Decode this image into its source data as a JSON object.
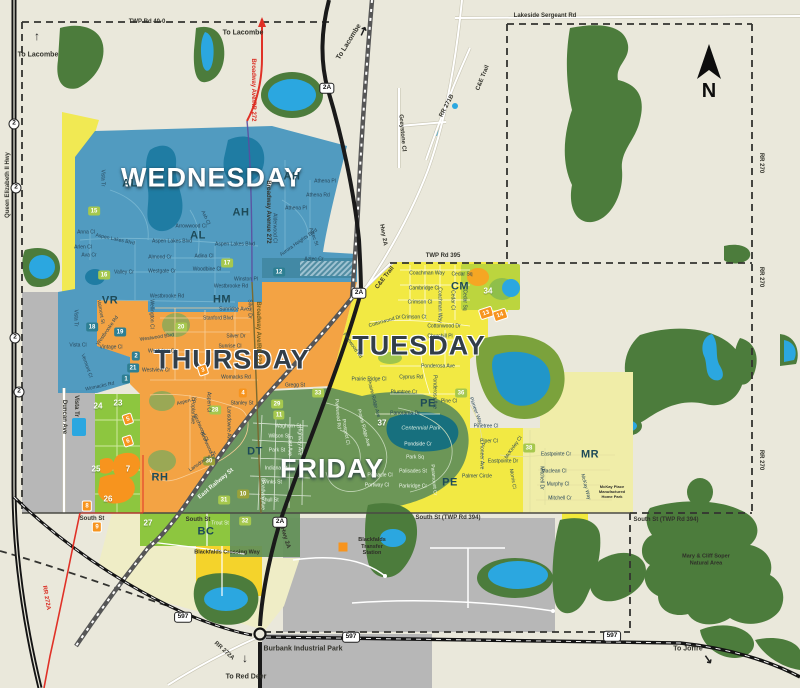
{
  "colors": {
    "background": "#EAE8DB",
    "forest": "#4C7C3C",
    "water": "#2BA7E0",
    "wednesday": "#4796BE",
    "thursday": "#F2A03D",
    "tuesday": "#F2E93B",
    "friday": "#639158",
    "pale_yellow_mr": "#F0EDA8",
    "pale_yellow_bc": "#EFEDC6",
    "green_strip": "#8DC63F",
    "gray_area": "#B7B7B7",
    "road_black": "#1A1A1A",
    "road_red": "#E03127",
    "box_green": "#A6C84E",
    "box_teal": "#2E7F93",
    "box_orange": "#F7941E"
  },
  "compass": {
    "label": "N"
  },
  "day_labels": [
    {
      "t": "WEDNESDAY",
      "x": 212,
      "y": 178,
      "k": "light"
    },
    {
      "t": "THURSDAY",
      "x": 232,
      "y": 360,
      "k": "dark"
    },
    {
      "t": "TUESDAY",
      "x": 419,
      "y": 346,
      "k": "dark"
    },
    {
      "t": "FRIDAY",
      "x": 332,
      "y": 469,
      "k": "light"
    }
  ],
  "district_labels": [
    {
      "t": "AL",
      "x": 130,
      "y": 184
    },
    {
      "t": "AH",
      "x": 292,
      "y": 177
    },
    {
      "t": "AH",
      "x": 241,
      "y": 213
    },
    {
      "t": "AL",
      "x": 198,
      "y": 236
    },
    {
      "t": "VR",
      "x": 110,
      "y": 301
    },
    {
      "t": "HM",
      "x": 222,
      "y": 300
    },
    {
      "t": "CM",
      "x": 460,
      "y": 287
    },
    {
      "t": "PE",
      "x": 428,
      "y": 404
    },
    {
      "t": "PE",
      "x": 450,
      "y": 483
    },
    {
      "t": "DT",
      "x": 255,
      "y": 452
    },
    {
      "t": "RH",
      "x": 160,
      "y": 478
    },
    {
      "t": "BC",
      "x": 206,
      "y": 532
    },
    {
      "t": "MR",
      "x": 590,
      "y": 455
    }
  ],
  "markers_green": [
    {
      "t": "15",
      "x": 94,
      "y": 211
    },
    {
      "t": "16",
      "x": 104,
      "y": 275
    },
    {
      "t": "17",
      "x": 227,
      "y": 263
    },
    {
      "t": "20",
      "x": 181,
      "y": 327
    },
    {
      "t": "28",
      "x": 215,
      "y": 410
    },
    {
      "t": "29",
      "x": 277,
      "y": 404
    },
    {
      "t": "11",
      "x": 279,
      "y": 415
    },
    {
      "t": "31",
      "x": 224,
      "y": 500
    },
    {
      "t": "32",
      "x": 245,
      "y": 521
    },
    {
      "t": "33",
      "x": 318,
      "y": 393
    },
    {
      "t": "36",
      "x": 461,
      "y": 393
    },
    {
      "t": "38",
      "x": 529,
      "y": 448
    }
  ],
  "markers_teal": [
    {
      "t": "12",
      "x": 279,
      "y": 272
    },
    {
      "t": "18",
      "x": 92,
      "y": 327
    },
    {
      "t": "19",
      "x": 120,
      "y": 332
    },
    {
      "t": "2",
      "x": 136,
      "y": 356
    },
    {
      "t": "21",
      "x": 133,
      "y": 368
    },
    {
      "t": "1",
      "x": 126,
      "y": 379
    }
  ],
  "markers_orange": [
    {
      "t": "4",
      "x": 243,
      "y": 393
    },
    {
      "t": "8",
      "x": 87,
      "y": 506,
      "k": "bordered"
    },
    {
      "t": "9",
      "x": 97,
      "y": 527,
      "k": "bordered"
    }
  ],
  "markers_tilted": [
    {
      "t": "3",
      "x": 203,
      "y": 370
    },
    {
      "t": "5",
      "x": 128,
      "y": 419
    },
    {
      "t": "6",
      "x": 128,
      "y": 441
    },
    {
      "t": "13",
      "x": 486,
      "y": 313
    },
    {
      "t": "14",
      "x": 500,
      "y": 315
    }
  ],
  "markers_olive": [
    {
      "t": "10",
      "x": 243,
      "y": 494
    },
    {
      "t": "30",
      "x": 209,
      "y": 461
    }
  ],
  "markers_plain": [
    {
      "t": "23",
      "x": 118,
      "y": 403
    },
    {
      "t": "24",
      "x": 98,
      "y": 406
    },
    {
      "t": "25",
      "x": 96,
      "y": 469
    },
    {
      "t": "26",
      "x": 108,
      "y": 499
    },
    {
      "t": "27",
      "x": 148,
      "y": 523
    },
    {
      "t": "34",
      "x": 488,
      "y": 291
    },
    {
      "t": "37",
      "x": 382,
      "y": 423
    },
    {
      "t": "7",
      "x": 128,
      "y": 469
    }
  ],
  "street_labels": [
    {
      "t": "Vista Tr",
      "x": 102,
      "y": 178,
      "r": 90
    },
    {
      "t": "Athena Pl",
      "x": 325,
      "y": 182
    },
    {
      "t": "Athena Rd",
      "x": 318,
      "y": 196
    },
    {
      "t": "Athena Pl",
      "x": 296,
      "y": 209
    },
    {
      "t": "Alderwood Cl",
      "x": 274,
      "y": 228,
      "r": 90
    },
    {
      "t": "Aurora Heights Blvd",
      "x": 299,
      "y": 243,
      "r": -35
    },
    {
      "t": "Aztec St",
      "x": 313,
      "y": 237,
      "r": 70
    },
    {
      "t": "Aztec Cr",
      "x": 314,
      "y": 260
    },
    {
      "t": "Arrowwood Cl",
      "x": 191,
      "y": 227
    },
    {
      "t": "Ash Cl",
      "x": 205,
      "y": 218,
      "r": 65
    },
    {
      "t": "Aspen Lakes Blvd",
      "x": 115,
      "y": 240,
      "r": 12
    },
    {
      "t": "Aspen Lakes Blvd",
      "x": 172,
      "y": 242
    },
    {
      "t": "Aspen Lakes Blvd",
      "x": 235,
      "y": 245
    },
    {
      "t": "Anna Cl",
      "x": 86,
      "y": 233
    },
    {
      "t": "Arlen Cl",
      "x": 83,
      "y": 248
    },
    {
      "t": "Ava Cr",
      "x": 89,
      "y": 256
    },
    {
      "t": "Adina Cl",
      "x": 204,
      "y": 257
    },
    {
      "t": "Almond Cr",
      "x": 160,
      "y": 258
    },
    {
      "t": "Woodbine Cl",
      "x": 207,
      "y": 270
    },
    {
      "t": "Westgate Cr",
      "x": 162,
      "y": 272
    },
    {
      "t": "Valley Cr",
      "x": 124,
      "y": 273
    },
    {
      "t": "Winston Pl",
      "x": 246,
      "y": 280
    },
    {
      "t": "Westbrooke Rd",
      "x": 231,
      "y": 287
    },
    {
      "t": "Westbrooke Rd",
      "x": 167,
      "y": 297
    },
    {
      "t": "Valmont St",
      "x": 100,
      "y": 312,
      "r": 80
    },
    {
      "t": "Vista Tr",
      "x": 75,
      "y": 318,
      "r": 90
    },
    {
      "t": "Westbrooke Rd",
      "x": 108,
      "y": 331,
      "r": -55
    },
    {
      "t": "Vintage Cl",
      "x": 111,
      "y": 348
    },
    {
      "t": "Vista Cl",
      "x": 78,
      "y": 346
    },
    {
      "t": "Vermont Cl",
      "x": 86,
      "y": 366,
      "r": 70
    },
    {
      "t": "Womacks Rd",
      "x": 100,
      "y": 387,
      "r": -12
    },
    {
      "t": "Wellington Cl",
      "x": 151,
      "y": 314,
      "r": 90
    },
    {
      "t": "Sunridge Ave",
      "x": 234,
      "y": 310
    },
    {
      "t": "Stanford Blvd",
      "x": 218,
      "y": 319
    },
    {
      "t": "Silver Dr",
      "x": 249,
      "y": 309,
      "r": 90
    },
    {
      "t": "Silver Dr",
      "x": 236,
      "y": 337
    },
    {
      "t": "Sunrise Cl",
      "x": 230,
      "y": 347
    },
    {
      "t": "Westwood Blvd",
      "x": 157,
      "y": 338,
      "r": -8
    },
    {
      "t": "Westview Cr",
      "x": 162,
      "y": 352
    },
    {
      "t": "Westview Cr",
      "x": 156,
      "y": 371
    },
    {
      "t": "Womacks Rd",
      "x": 236,
      "y": 378
    },
    {
      "t": "Gregg St",
      "x": 295,
      "y": 386
    },
    {
      "t": "Aspen Dr",
      "x": 187,
      "y": 402,
      "r": -15
    },
    {
      "t": "Poplar Ave",
      "x": 192,
      "y": 412,
      "r": 90
    },
    {
      "t": "Aspen Cl",
      "x": 208,
      "y": 402,
      "r": 90
    },
    {
      "t": "Stanley St",
      "x": 242,
      "y": 404
    },
    {
      "t": "Birchwood Cl",
      "x": 200,
      "y": 428,
      "r": 65
    },
    {
      "t": "Birchwood Dr",
      "x": 207,
      "y": 446,
      "r": 65
    },
    {
      "t": "Lansdowne Ave",
      "x": 228,
      "y": 424,
      "r": 90
    },
    {
      "t": "Lansdowne Dr",
      "x": 203,
      "y": 462,
      "r": -35
    },
    {
      "t": "Waghorn St",
      "x": 288,
      "y": 427,
      "k": "w"
    },
    {
      "t": "Wilson St",
      "x": 279,
      "y": 437,
      "k": "w"
    },
    {
      "t": "East Ave",
      "x": 289,
      "y": 446,
      "r": 90,
      "k": "w"
    },
    {
      "t": "Highway Ave",
      "x": 299,
      "y": 441,
      "r": 90,
      "k": "w"
    },
    {
      "t": "Park St",
      "x": 277,
      "y": 451,
      "k": "w"
    },
    {
      "t": "Indiana St",
      "x": 276,
      "y": 469,
      "k": "w"
    },
    {
      "t": "Winks St",
      "x": 272,
      "y": 483,
      "k": "w"
    },
    {
      "t": "Shull St",
      "x": 270,
      "y": 501,
      "k": "w"
    },
    {
      "t": "Broadway Ave",
      "x": 262,
      "y": 494,
      "r": 90,
      "k": "w"
    },
    {
      "t": "Trout St",
      "x": 220,
      "y": 524,
      "k": "w"
    },
    {
      "t": "Coachman Way",
      "x": 427,
      "y": 274
    },
    {
      "t": "Cedar Sq",
      "x": 462,
      "y": 275
    },
    {
      "t": "Cambridge Cl",
      "x": 424,
      "y": 289
    },
    {
      "t": "Crimson Cl",
      "x": 420,
      "y": 303
    },
    {
      "t": "Crimson Ct",
      "x": 414,
      "y": 318
    },
    {
      "t": "Coachman Way",
      "x": 439,
      "y": 305,
      "r": 90
    },
    {
      "t": "Cedar Cl",
      "x": 452,
      "y": 300,
      "r": 90
    },
    {
      "t": "Cedar Sq",
      "x": 464,
      "y": 300,
      "r": 90
    },
    {
      "t": "Cottonwood Dr",
      "x": 385,
      "y": 322,
      "r": -16
    },
    {
      "t": "Cottonwood Dr",
      "x": 444,
      "y": 327
    },
    {
      "t": "Churchill Pl",
      "x": 440,
      "y": 337
    },
    {
      "t": "Ponderosa Ave",
      "x": 438,
      "y": 367
    },
    {
      "t": "Ponderosa Ave",
      "x": 434,
      "y": 392,
      "r": 90
    },
    {
      "t": "Cyprus Rd",
      "x": 411,
      "y": 378
    },
    {
      "t": "Plumtree Cr",
      "x": 404,
      "y": 393
    },
    {
      "t": "Pine Cl",
      "x": 449,
      "y": 402
    },
    {
      "t": "Pinewood Rd",
      "x": 352,
      "y": 346,
      "r": 55
    },
    {
      "t": "Prairie Ridge Cl",
      "x": 369,
      "y": 380
    },
    {
      "t": "Prairie Ridge Ave",
      "x": 373,
      "y": 399,
      "r": 75
    },
    {
      "t": "Panorama Dr",
      "x": 405,
      "y": 414
    },
    {
      "t": "Parkwood Rd",
      "x": 337,
      "y": 414,
      "r": 85,
      "k": "w"
    },
    {
      "t": "Prospect Cl",
      "x": 345,
      "y": 432,
      "r": 80,
      "k": "w"
    },
    {
      "t": "Prairie Ridge Ave",
      "x": 363,
      "y": 428,
      "r": 75,
      "k": "w"
    },
    {
      "t": "Pondside Cr",
      "x": 418,
      "y": 445,
      "k": "w"
    },
    {
      "t": "Park Sq",
      "x": 415,
      "y": 458,
      "k": "w"
    },
    {
      "t": "Palisades St",
      "x": 413,
      "y": 472,
      "k": "w"
    },
    {
      "t": "Pinnacle Cl",
      "x": 380,
      "y": 476,
      "k": "w"
    },
    {
      "t": "Portway Cl",
      "x": 377,
      "y": 486,
      "k": "w"
    },
    {
      "t": "Parkridge Cr",
      "x": 413,
      "y": 487,
      "k": "w"
    },
    {
      "t": "Paramount Cr",
      "x": 433,
      "y": 480,
      "r": 85,
      "k": "w"
    },
    {
      "t": "Pioneer Way",
      "x": 475,
      "y": 411,
      "r": 70
    },
    {
      "t": "Pinetree Cl",
      "x": 486,
      "y": 427
    },
    {
      "t": "Piper Cl",
      "x": 489,
      "y": 442
    },
    {
      "t": "Pioneer Ave",
      "x": 481,
      "y": 456,
      "r": 90
    },
    {
      "t": "Palmer Circle",
      "x": 477,
      "y": 477
    },
    {
      "t": "Eastpointe Dr",
      "x": 503,
      "y": 462
    },
    {
      "t": "Eastpointe Cr",
      "x": 556,
      "y": 455
    },
    {
      "t": "Maclean Cl",
      "x": 554,
      "y": 472
    },
    {
      "t": "Murphy Cl",
      "x": 558,
      "y": 485
    },
    {
      "t": "Mitchell Cr",
      "x": 560,
      "y": 499
    },
    {
      "t": "Mitchell Dr",
      "x": 541,
      "y": 478,
      "r": 90
    },
    {
      "t": "Morris Cl",
      "x": 512,
      "y": 479,
      "r": 80
    },
    {
      "t": "McKinley Cl",
      "x": 514,
      "y": 448,
      "r": -55
    },
    {
      "t": "McKay Way",
      "x": 585,
      "y": 487,
      "r": 75
    }
  ],
  "road_labels": [
    {
      "t": "TWP Rd 40-0",
      "x": 147,
      "y": 22
    },
    {
      "t": "Lakeside Sergeant Rd",
      "x": 545,
      "y": 16
    },
    {
      "t": "TWP Rd 395",
      "x": 443,
      "y": 256
    },
    {
      "t": "South St",
      "x": 92,
      "y": 519
    },
    {
      "t": "South St",
      "x": 198,
      "y": 520
    },
    {
      "t": "South St (TWP Rd 394)",
      "x": 448,
      "y": 518
    },
    {
      "t": "South St (TWP Rd 394)",
      "x": 666,
      "y": 520
    },
    {
      "t": "RR 270",
      "x": 761,
      "y": 163,
      "r": 90
    },
    {
      "t": "RR 270",
      "x": 761,
      "y": 277,
      "r": 90
    },
    {
      "t": "RR 270",
      "x": 761,
      "y": 460,
      "r": 90
    },
    {
      "t": "C&E Trail",
      "x": 483,
      "y": 78,
      "r": -68
    },
    {
      "t": "C&E Trail",
      "x": 385,
      "y": 278,
      "r": -52
    },
    {
      "t": "RR 271B",
      "x": 447,
      "y": 106,
      "r": -62
    },
    {
      "t": "Greystone Cl",
      "x": 402,
      "y": 133,
      "r": 85
    },
    {
      "t": "Hwy 2A",
      "x": 383,
      "y": 235,
      "r": 80
    },
    {
      "t": "Hwy 2A",
      "x": 285,
      "y": 538,
      "r": 73
    },
    {
      "t": "Queen Elizabeth II Hwy",
      "x": 8,
      "y": 185,
      "r": -90
    },
    {
      "t": "Broadway Ave/RR 272",
      "x": 253,
      "y": 90,
      "r": 90,
      "k": "red"
    },
    {
      "t": "Broadway Avenue 272",
      "x": 268,
      "y": 212,
      "r": 90
    },
    {
      "t": "Broadway Ave/RR 272",
      "x": 258,
      "y": 333,
      "r": 90,
      "k": "olive"
    },
    {
      "t": "RR 272A",
      "x": 46,
      "y": 598,
      "r": 80,
      "k": "red"
    },
    {
      "t": "RR 272A",
      "x": 224,
      "y": 651,
      "r": 42
    },
    {
      "t": "Burbank Industrial Park",
      "x": 303,
      "y": 649,
      "k": "big"
    },
    {
      "t": "East Railway St",
      "x": 216,
      "y": 484,
      "r": -40,
      "k": "white"
    },
    {
      "t": "Duncan Ave",
      "x": 64,
      "y": 417,
      "r": 90
    },
    {
      "t": "Vista Tr",
      "x": 76,
      "y": 406,
      "r": 90
    }
  ],
  "shields": [
    {
      "t": "2",
      "x": 14,
      "y": 124,
      "k": "circle"
    },
    {
      "t": "2",
      "x": 16,
      "y": 188,
      "k": "circle"
    },
    {
      "t": "2",
      "x": 15,
      "y": 338,
      "k": "circle"
    },
    {
      "t": "2",
      "x": 19,
      "y": 392,
      "k": "circle"
    },
    {
      "t": "2A",
      "x": 327,
      "y": 88
    },
    {
      "t": "2A",
      "x": 359,
      "y": 293
    },
    {
      "t": "2A",
      "x": 280,
      "y": 522
    },
    {
      "t": "597",
      "x": 183,
      "y": 617
    },
    {
      "t": "597",
      "x": 351,
      "y": 637
    },
    {
      "t": "597",
      "x": 612,
      "y": 636
    }
  ],
  "pois": [
    {
      "t": "Blackfalds\nTransfer\nStation",
      "x": 372,
      "y": 547
    },
    {
      "t": "Blackfalds Crossing Way",
      "x": 227,
      "y": 553
    },
    {
      "t": "Mary & Cliff Soper\nNatural Area",
      "x": 706,
      "y": 560
    },
    {
      "t": "Centennial Park",
      "x": 421,
      "y": 429,
      "k": "park"
    },
    {
      "t": "McKay Place\nManufactured\nHome Park",
      "x": 612,
      "y": 492,
      "k": "tiny"
    }
  ],
  "directions": [
    {
      "t": "To Lacombe",
      "x": 38,
      "y": 55
    },
    {
      "t": "To Lacombe",
      "x": 243,
      "y": 33
    },
    {
      "t": "To Lacombe",
      "x": 349,
      "y": 42,
      "r": -58
    },
    {
      "t": "To Red Deer",
      "x": 246,
      "y": 677
    },
    {
      "t": "To Joffre",
      "x": 688,
      "y": 649
    }
  ],
  "arrows": [
    {
      "g": "↑",
      "x": 37,
      "y": 36
    },
    {
      "g": "↑",
      "x": 262,
      "y": 21,
      "k": "red"
    },
    {
      "g": "↗",
      "x": 363,
      "y": 31,
      "r": -20
    },
    {
      "g": "↓",
      "x": 245,
      "y": 658
    },
    {
      "g": "↘",
      "x": 708,
      "y": 659,
      "r": 10
    }
  ],
  "icons": [
    {
      "x": 343,
      "y": 547,
      "k": "transfer-square"
    }
  ]
}
